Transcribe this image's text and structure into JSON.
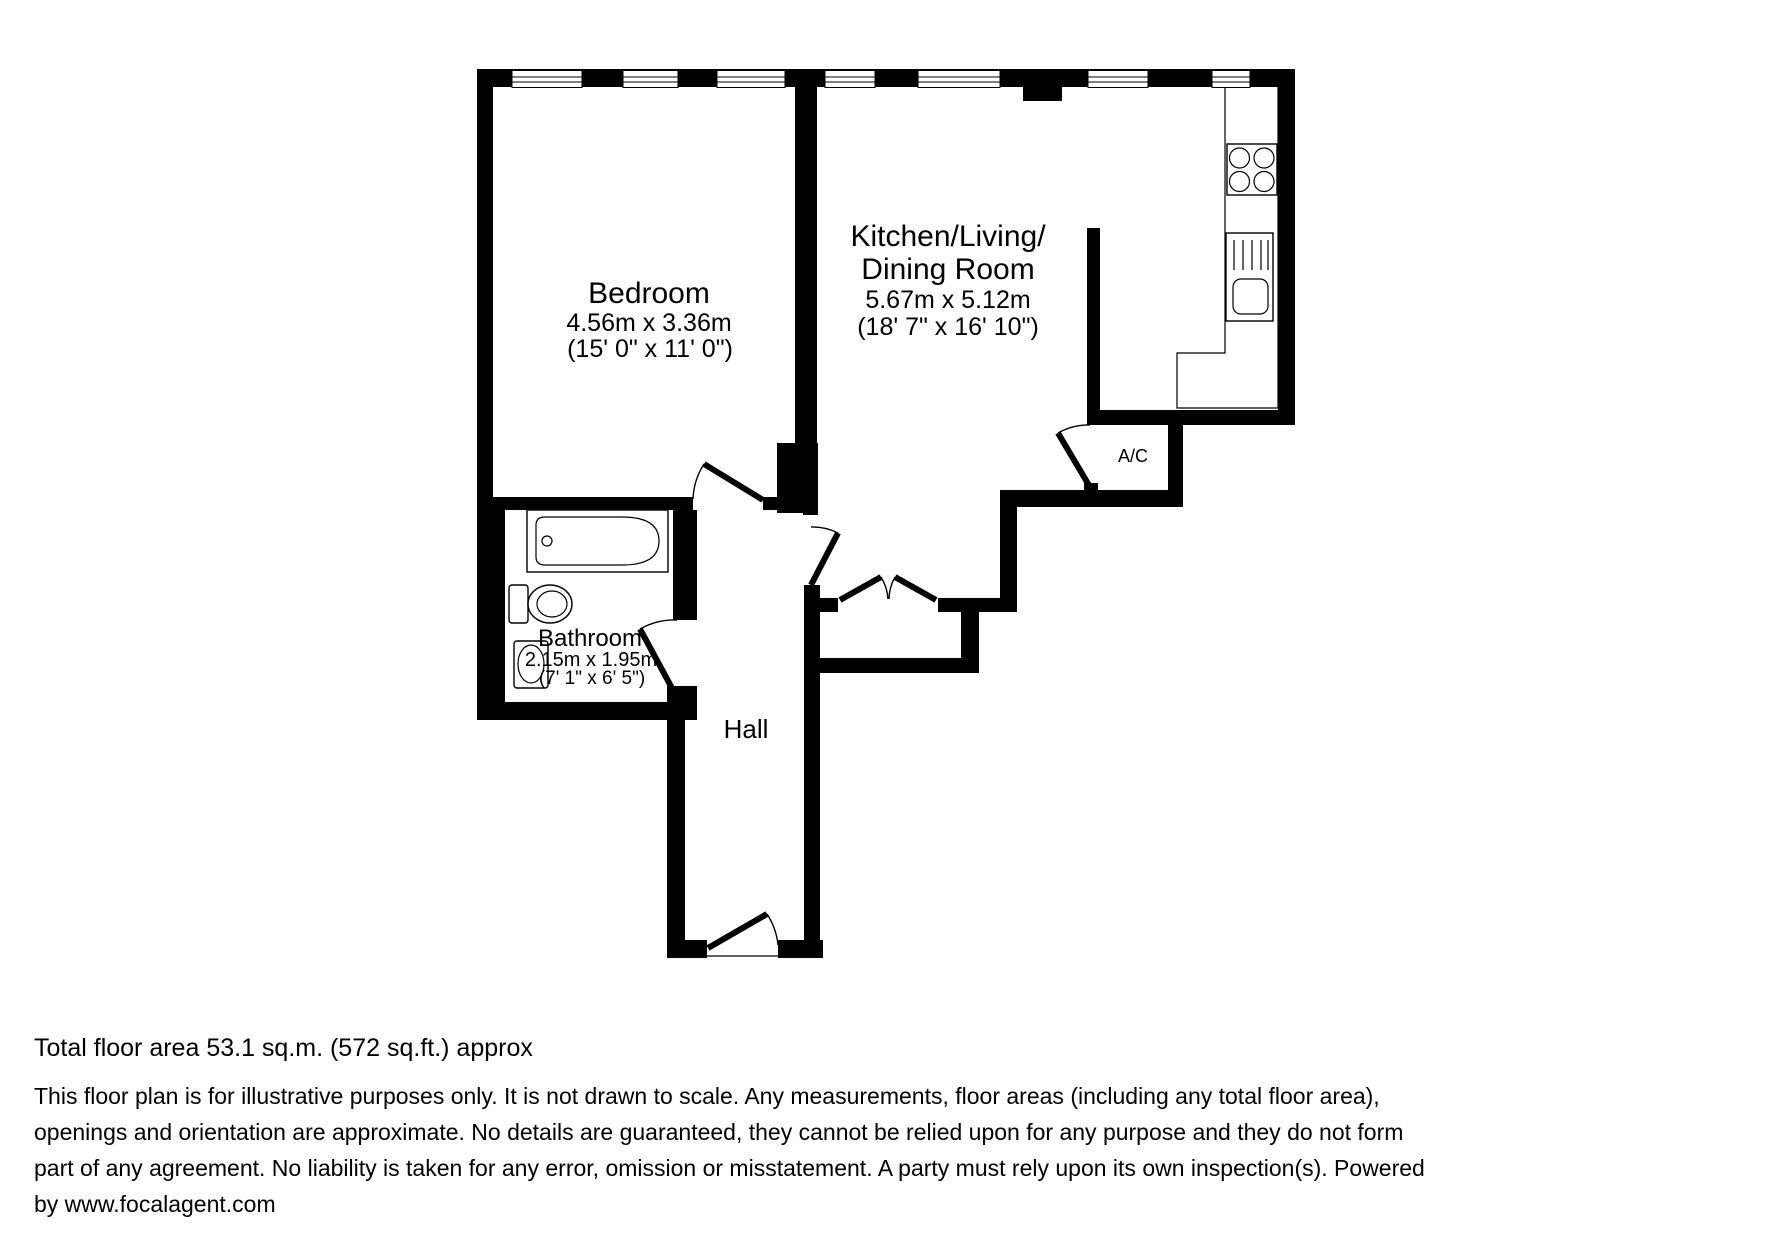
{
  "floorplan": {
    "rooms": {
      "bedroom": {
        "name": "Bedroom",
        "metric": "4.56m x 3.36m",
        "imperial": "(15' 0\" x 11' 0\")"
      },
      "kitchen": {
        "name_line1": "Kitchen/Living/",
        "name_line2": "Dining Room",
        "metric": "5.67m x 5.12m",
        "imperial": "(18' 7\" x 16' 10\")"
      },
      "bathroom": {
        "name": "Bathroom",
        "metric": "2.15m x 1.95m",
        "imperial": "(7' 1\" x 6' 5\")"
      },
      "hall": {
        "name": "Hall"
      },
      "ac_closet": {
        "name": "A/C"
      }
    },
    "colors": {
      "wall": "#000000",
      "background": "#ffffff"
    }
  },
  "footer": {
    "total_area": "Total floor area 53.1 sq.m. (572 sq.ft.) approx",
    "disclaimer_line1": "This floor plan is for illustrative purposes only. It is not drawn to scale. Any measurements, floor areas (including any total floor area),",
    "disclaimer_line2": "openings and orientation are approximate. No details are guaranteed, they cannot be relied upon for any purpose and they do not form",
    "disclaimer_line3": "part of any agreement. No liability is taken for any error, omission or misstatement. A party must rely upon its own inspection(s). Powered",
    "disclaimer_line4": "by www.focalagent.com"
  }
}
